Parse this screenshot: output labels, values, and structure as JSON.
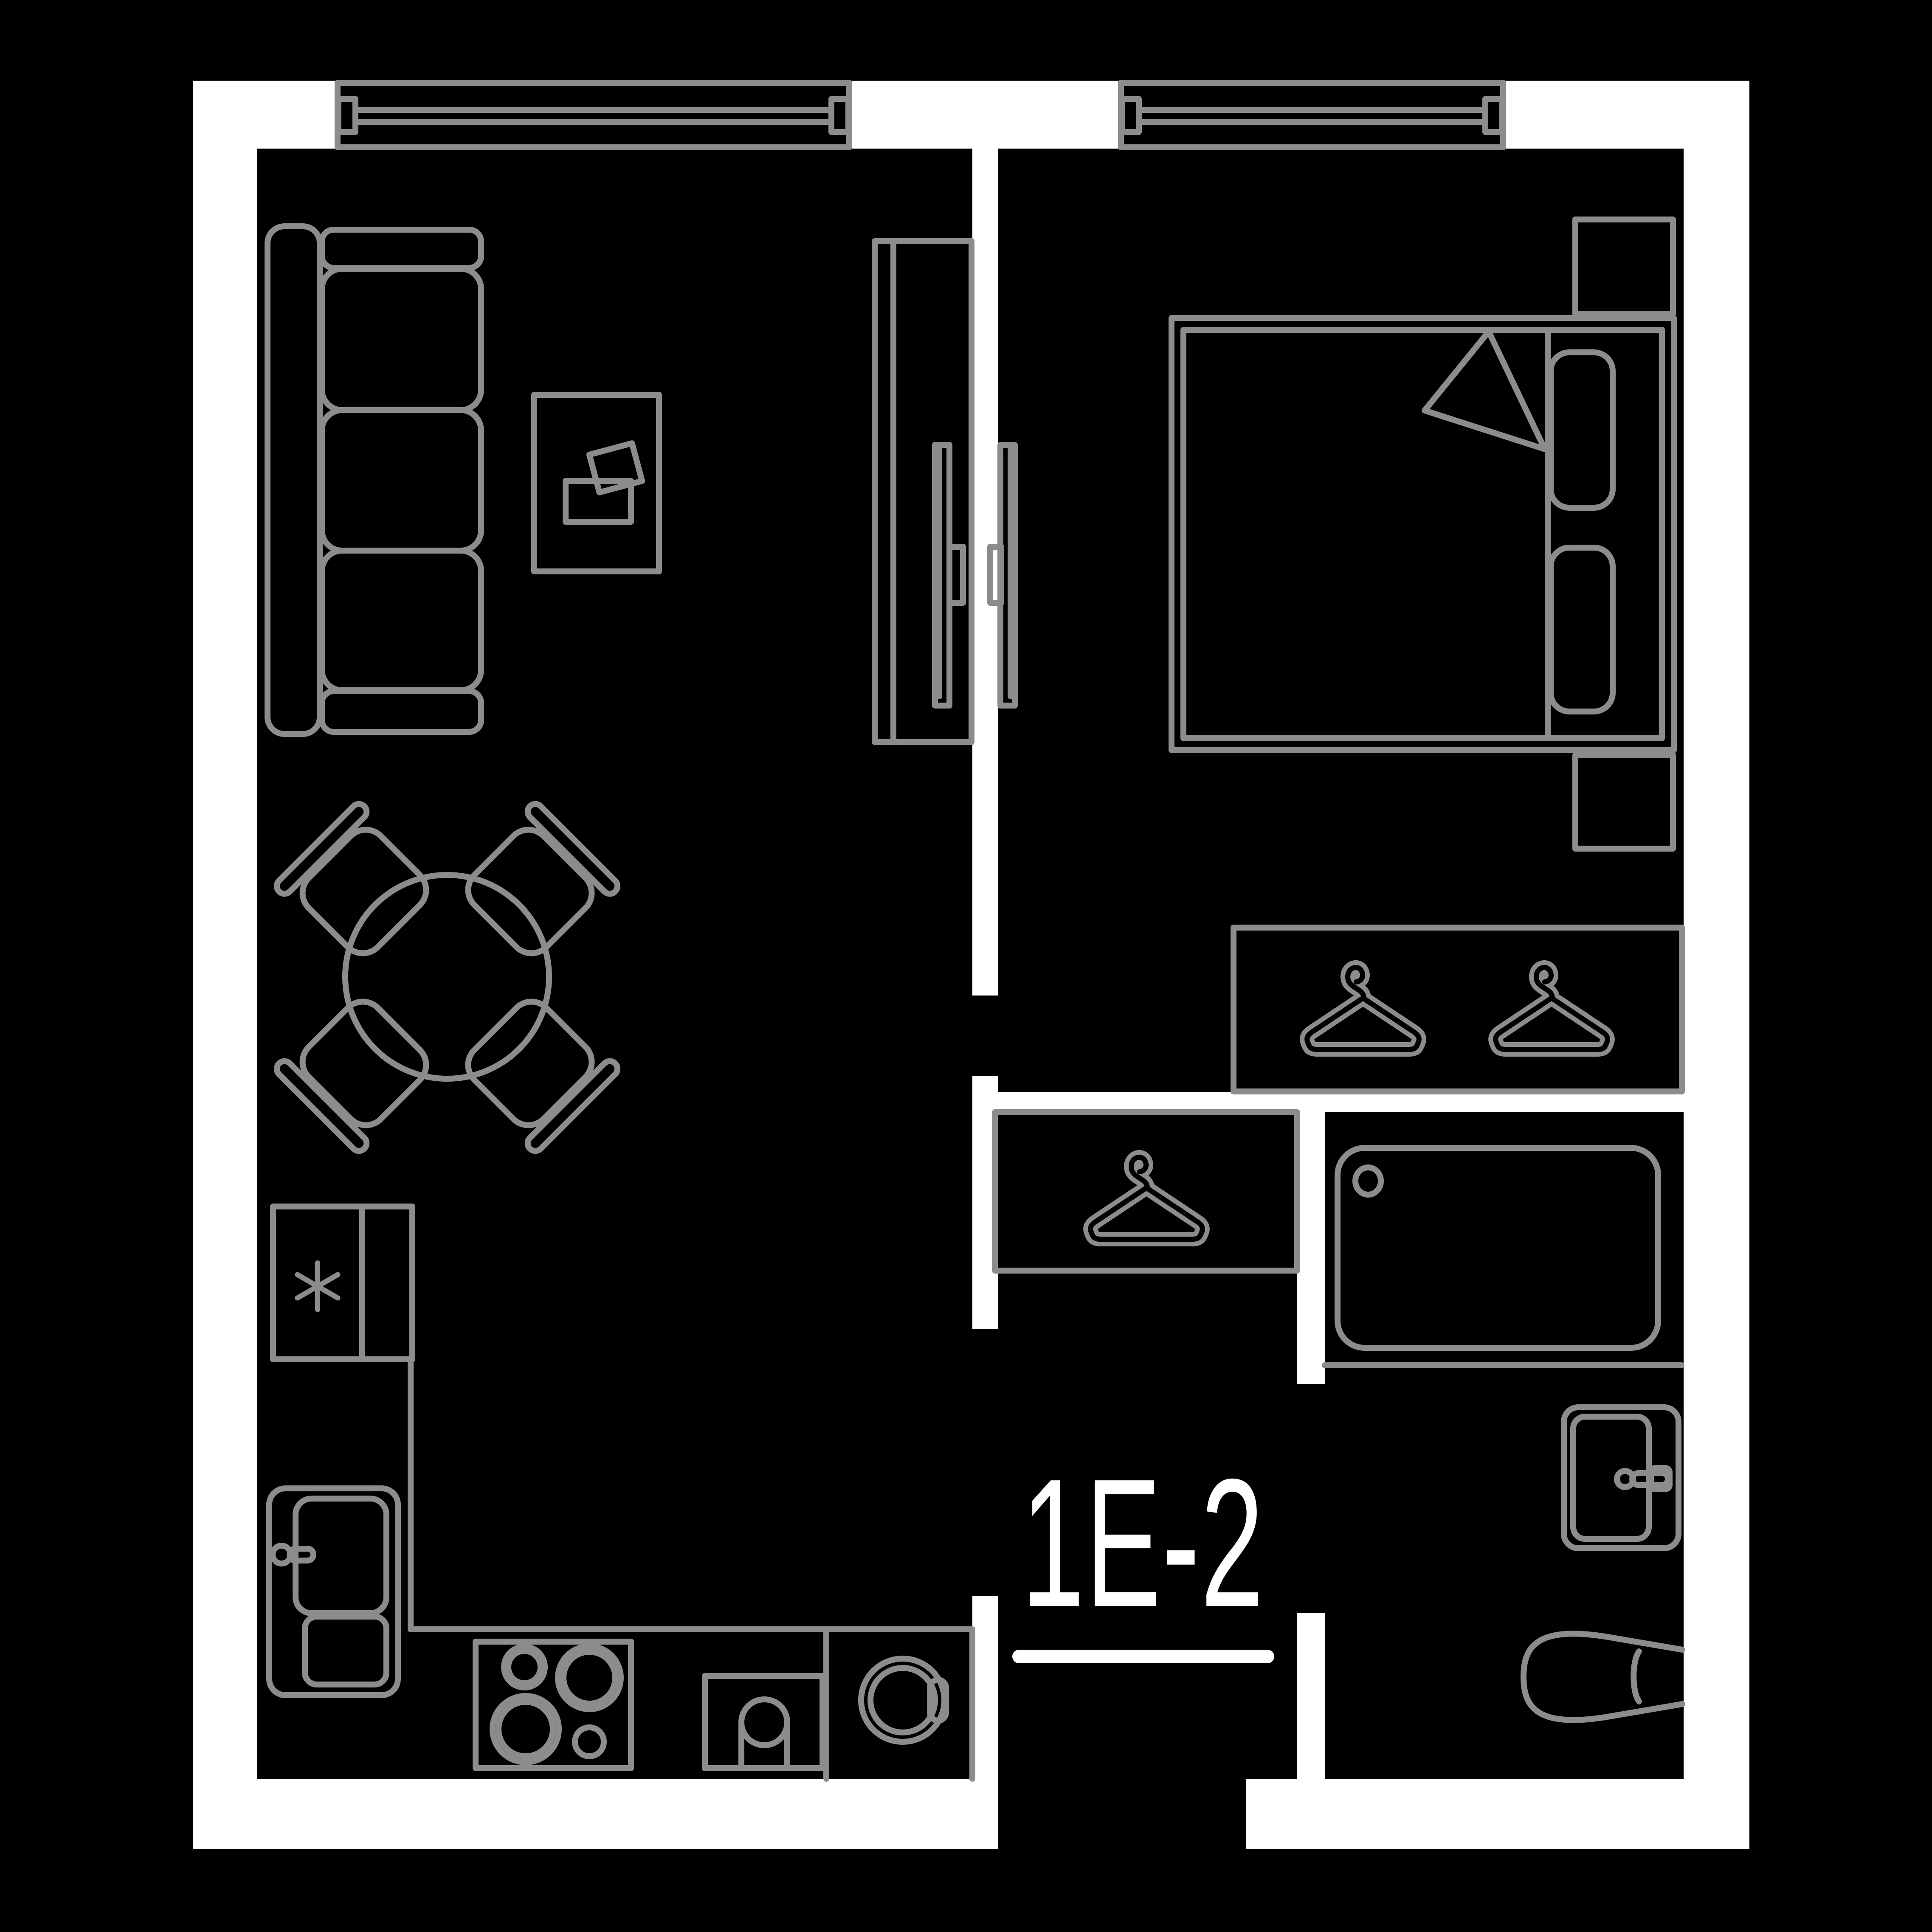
{
  "unit": {
    "label": "1E-2"
  },
  "colors": {
    "background": "#000000",
    "wall": "#ffffff",
    "furniture": "#8c8c8c",
    "text": "#ffffff"
  },
  "plan": {
    "type": "apartment-floor-plan",
    "objects": [
      "window",
      "sofa",
      "coffee-table",
      "dining-table",
      "dining-chair",
      "tv-cabinet",
      "tv",
      "bed",
      "pillow",
      "blanket",
      "nightstand",
      "wardrobe",
      "clothes-hanger",
      "hallway-closet",
      "bathtub",
      "washbasin",
      "toilet",
      "fridge",
      "kitchen-counter",
      "kitchen-sink",
      "hob",
      "oven",
      "washing-machine"
    ]
  }
}
